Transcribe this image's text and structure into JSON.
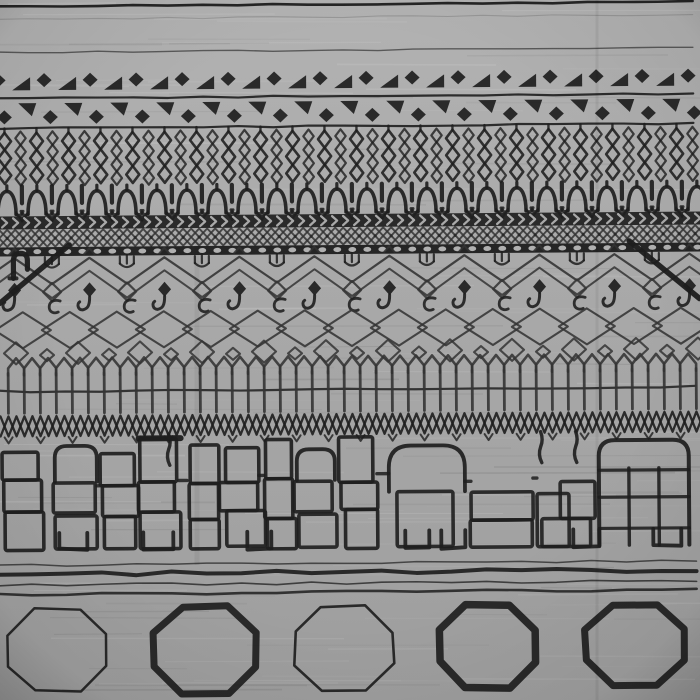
{
  "scene": {
    "type": "photograph",
    "subject": "Gray and charcoal Moroccan Berber-style wool rug with black tribal geometric pattern, flat top-down crop",
    "composition": "horizontal pattern bands: top lines, triangle-diamond rows, diamond-chain columns, wishbone arches, chevron braid, dotted bar, zigzag field with hooked pendants, interlocking diamond lattice, arched fence posts, irregular stacked brick towers, wavy lines, octagon medallion row",
    "visible_text": "none"
  },
  "palette": {
    "background_top": "#b2b2b2",
    "background_mid": "#a9a9a9",
    "background_bottom": "#9e9e9e",
    "ink": "#1e1e1e",
    "ink_soft": "#343434",
    "pale": "#c9c9c9",
    "vignette": "#000000"
  },
  "render": {
    "seed": 11,
    "width": 700,
    "height": 700,
    "streak_count": 150,
    "tilt_deg": -0.4
  },
  "bands": [
    {
      "type": "hline",
      "y": 4,
      "w": 2.6,
      "op": 0.95
    },
    {
      "type": "hline",
      "y": 17,
      "w": 1.1,
      "op": 0.18
    },
    {
      "type": "hline",
      "y": 50,
      "w": 1.4,
      "op": 0.6
    },
    {
      "type": "motif_row",
      "dir": "up",
      "tri_y": 88,
      "dia_y": 78,
      "tri_start": 23,
      "dia_start": 0,
      "step": 46
    },
    {
      "type": "hline",
      "y": 96,
      "w": 2.2,
      "op": 0.9
    },
    {
      "type": "motif_row",
      "dir": "down",
      "tri_y": 101,
      "dia_y": 115,
      "tri_start": 29,
      "dia_start": 6,
      "step": 46
    },
    {
      "type": "hline",
      "y": 126,
      "w": 2.2,
      "op": 0.9
    },
    {
      "type": "diamond_chains",
      "y_top": 129,
      "y_bot": 181,
      "step": 16
    },
    {
      "type": "fork_row",
      "y_top": 183,
      "y_base": 212,
      "step": 30
    },
    {
      "type": "chevron_band",
      "y": 214,
      "h": 13,
      "step": 11
    },
    {
      "type": "lattice_band",
      "y": 227,
      "h": 18,
      "step": 16
    },
    {
      "type": "dot_band",
      "y": 245,
      "h": 9,
      "step": 15
    },
    {
      "type": "field_top",
      "peak_y": 256,
      "valley_y": 282,
      "period": 75,
      "peak_x0": 15,
      "dia_y": 290,
      "hook_y": 288
    },
    {
      "type": "corner_motifs"
    },
    {
      "type": "big_lattice",
      "cy": 328,
      "rx": 28,
      "ry": 18,
      "step": 47,
      "x0": 23
    },
    {
      "type": "small_diamond_row",
      "cy": 351,
      "step": 31,
      "x0": 16
    },
    {
      "type": "fence",
      "apex_y": 356,
      "top_y": 371,
      "bot_y": 411,
      "step": 16,
      "rail_y": 389
    },
    {
      "type": "chain_band",
      "y_top": 414,
      "y_bot": 434,
      "step": 16
    },
    {
      "type": "towers"
    },
    {
      "type": "wavy_set"
    },
    {
      "type": "octagon_row"
    }
  ],
  "towers": [
    {
      "x": 4,
      "w": 38,
      "top": 450,
      "style": "brick"
    },
    {
      "x": 54,
      "w": 42,
      "top": 444,
      "style": "arch"
    },
    {
      "x": 102,
      "w": 34,
      "top": 452,
      "style": "brick"
    },
    {
      "x": 140,
      "w": 38,
      "top": 437,
      "style": "boldtop"
    },
    {
      "x": 186,
      "w": 30,
      "top": 444,
      "style": "brick"
    },
    {
      "x": 222,
      "w": 36,
      "top": 447,
      "style": "brick"
    },
    {
      "x": 263,
      "w": 27,
      "top": 439,
      "style": "brick"
    },
    {
      "x": 296,
      "w": 38,
      "top": 449,
      "style": "arch"
    },
    {
      "x": 341,
      "w": 35,
      "top": 437,
      "style": "brick"
    },
    {
      "x": 388,
      "w": 76,
      "top": 446,
      "style": "dome"
    },
    {
      "x": 470,
      "w": 62,
      "top": 493,
      "style": "low"
    },
    {
      "x": 536,
      "w": 58,
      "top": 483,
      "style": "steps"
    },
    {
      "x": 598,
      "w": 90,
      "top": 442,
      "style": "dome2"
    }
  ],
  "feet": [
    {
      "x": 58,
      "w": 28
    },
    {
      "x": 142,
      "w": 30
    },
    {
      "x": 246,
      "w": 24
    },
    {
      "x": 404,
      "w": 24
    },
    {
      "x": 440,
      "w": 24
    },
    {
      "x": 572,
      "w": 26
    },
    {
      "x": 652,
      "w": 28
    }
  ],
  "danglers": [
    {
      "x": 168
    },
    {
      "x": 540
    },
    {
      "x": 575
    }
  ],
  "wavy_lines": [
    {
      "y": 563,
      "w": 1.5,
      "op": 0.7
    },
    {
      "y": 572,
      "w": 4.0,
      "op": 0.92
    },
    {
      "y": 583,
      "w": 1.6,
      "op": 0.75
    },
    {
      "y": 592,
      "w": 2.6,
      "op": 0.85
    }
  ],
  "octagons": [
    {
      "cx": 55,
      "cy": 648,
      "rx": 50,
      "ry": 41,
      "sw": 2.5
    },
    {
      "cx": 203,
      "cy": 649,
      "rx": 51,
      "ry": 43,
      "sw": 7
    },
    {
      "cx": 342,
      "cy": 648,
      "rx": 49,
      "ry": 42,
      "sw": 2.6
    },
    {
      "cx": 485,
      "cy": 647,
      "rx": 48,
      "ry": 41,
      "sw": 7.5
    },
    {
      "cx": 633,
      "cy": 647,
      "rx": 50,
      "ry": 41,
      "sw": 7
    }
  ],
  "creases": [
    {
      "x": 597,
      "w": 3,
      "op": 0.06,
      "y1": 0,
      "y2": 700
    },
    {
      "x": 197,
      "w": 5,
      "op": 0.05,
      "y1": 240,
      "y2": 565
    }
  ]
}
